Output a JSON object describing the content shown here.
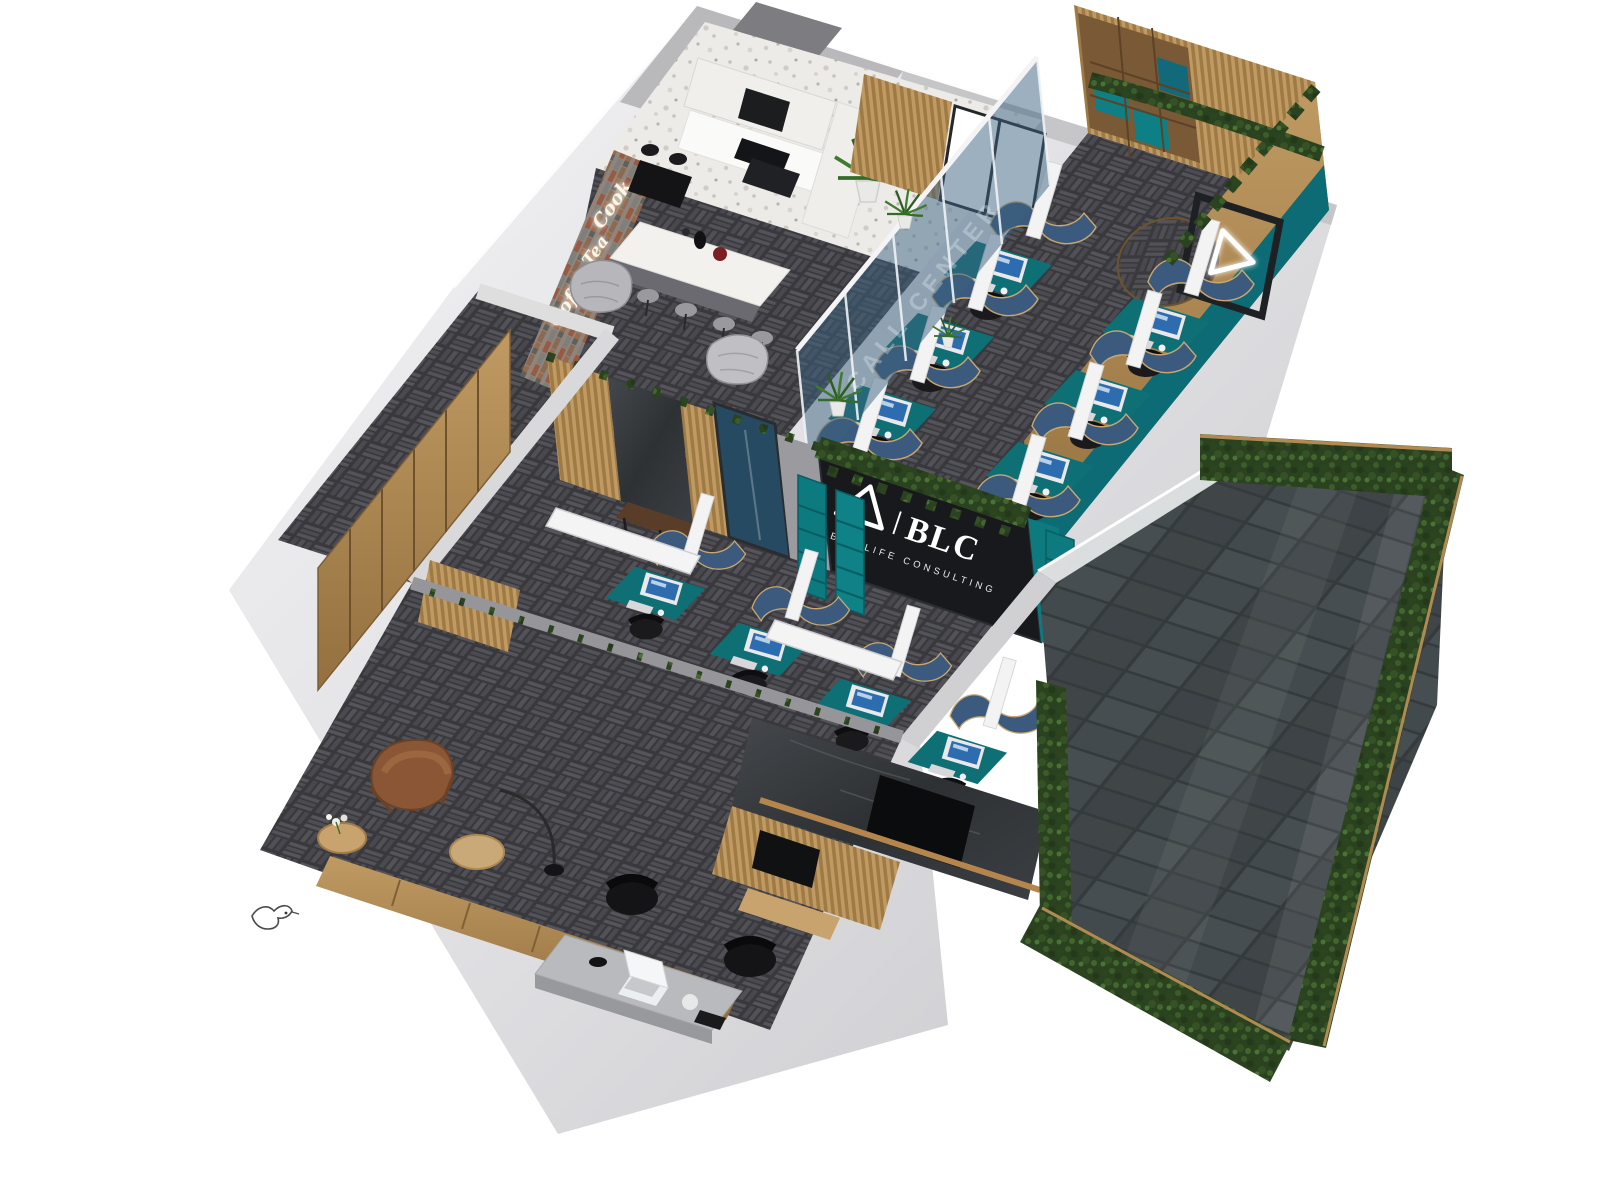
{
  "signage": {
    "blc_wall": {
      "brand": "BLC",
      "tagline": "BEE LIFE CONSULTING",
      "divider": "|",
      "panel_color": "#17191d",
      "text_color": "#ffffff",
      "logo_icon": "triangle-outline-icon"
    },
    "neon_brick_sign": {
      "style": "neon-script",
      "color": "#fff6e6",
      "words": {
        "w1": "Cook",
        "w2": "Tea",
        "w3": "Coffee"
      }
    },
    "glass_partition": {
      "etched_text": "CALL CENTER"
    },
    "wood_wall_badge": {
      "icon": "triangle-neon-icon",
      "color": "#ffffff"
    }
  },
  "palette": {
    "teal": "#0e7077",
    "denim": "#3c5a7d",
    "carpet": "#3f3f43",
    "wood": "#b58c58",
    "wall_gray": "#d9d9dc",
    "slate": "#42474a",
    "hedge": "#2a421f",
    "brick": "#9a5f45",
    "marble_dark": "#35383c",
    "panel_dark": "#17191d"
  },
  "rooms": {
    "kitchen": "kitchen-cafe",
    "call_center": "call-center",
    "open_office": "open-office-workstations",
    "executive": "executive-office",
    "corridor": "entry-wardrobe",
    "terrace": "terrace-garden"
  }
}
